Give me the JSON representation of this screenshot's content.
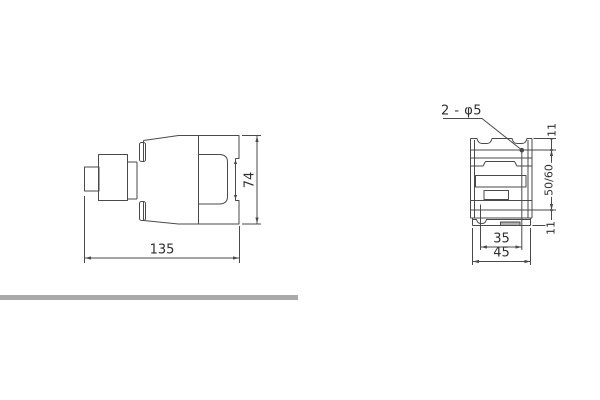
{
  "colors": {
    "line": "#4a4a4a",
    "text": "#2f2f2f",
    "divider_bar": "#a9a9a9",
    "clip_tab_fill": "#b0b0b0",
    "background": "#ffffff"
  },
  "side_view": {
    "label_width": "135",
    "label_height": "74"
  },
  "front_view": {
    "hole_callout": "2 - φ5",
    "label_top_offset": "11",
    "label_mounting_height": "50/60",
    "label_bottom_offset": "11",
    "label_hole_spacing": "35",
    "label_width": "45"
  }
}
